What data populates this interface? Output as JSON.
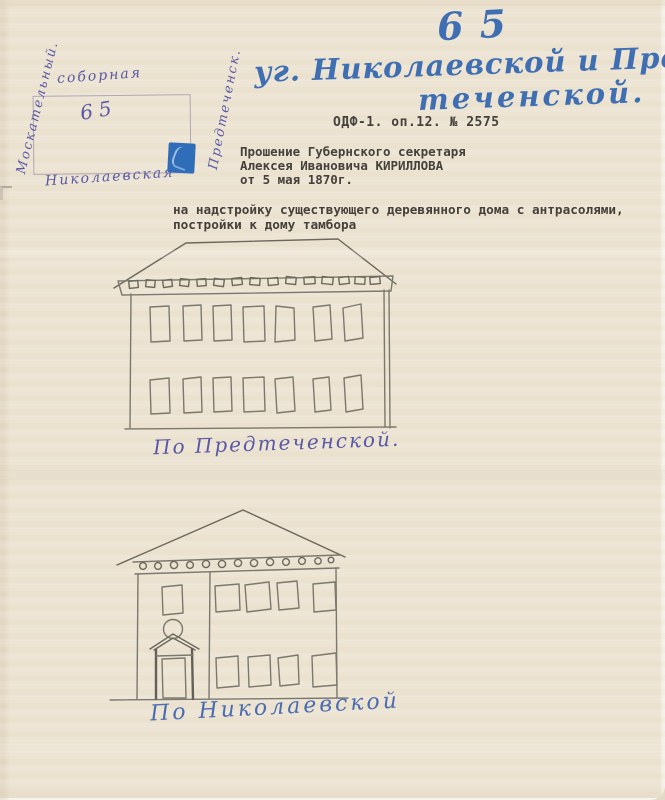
{
  "document": {
    "kind": "archival petition sheet with facade sketches",
    "header": {
      "plot_number": "65",
      "street_line1": "уг. Николаевской и Пред-",
      "street_line2": "теченской.",
      "archive_ref": "ОДФ-1. оп.12. № 2575"
    },
    "petition": {
      "line1": "Прошение Губернского секретаря",
      "line2": "Алексея Ивановича КИРИЛЛОВА",
      "line3": "от 5 мая 1870г."
    },
    "subject": {
      "line1": "на надстройку существующего деревянного дома с антрасолями,",
      "line2": "постройки к дому тамбора"
    },
    "site_plan": {
      "label_top": "соборная",
      "label_bottom": "Николаевская",
      "label_left": "Москательный.",
      "label_right": "Предтеченск.",
      "plot_number": "65",
      "marker_color": "#2f6db8"
    },
    "sketches": [
      {
        "caption": "По Предтеченской.",
        "windows_upper": 7,
        "windows_lower": 7,
        "features": [
          "hipped roof",
          "ornamental frieze"
        ]
      },
      {
        "caption": "По Николаевской",
        "windows_upper": 4,
        "windows_lower": 4,
        "features": [
          "gable roof",
          "ornamental frieze",
          "round window",
          "entrance door with pediment"
        ]
      }
    ],
    "colors": {
      "paper": "#ece3d2",
      "ink_blue": "#3f6fb2",
      "ink_violet": "#5a58a6",
      "typewriter": "#44403a",
      "pencil": "#7b786d"
    }
  }
}
